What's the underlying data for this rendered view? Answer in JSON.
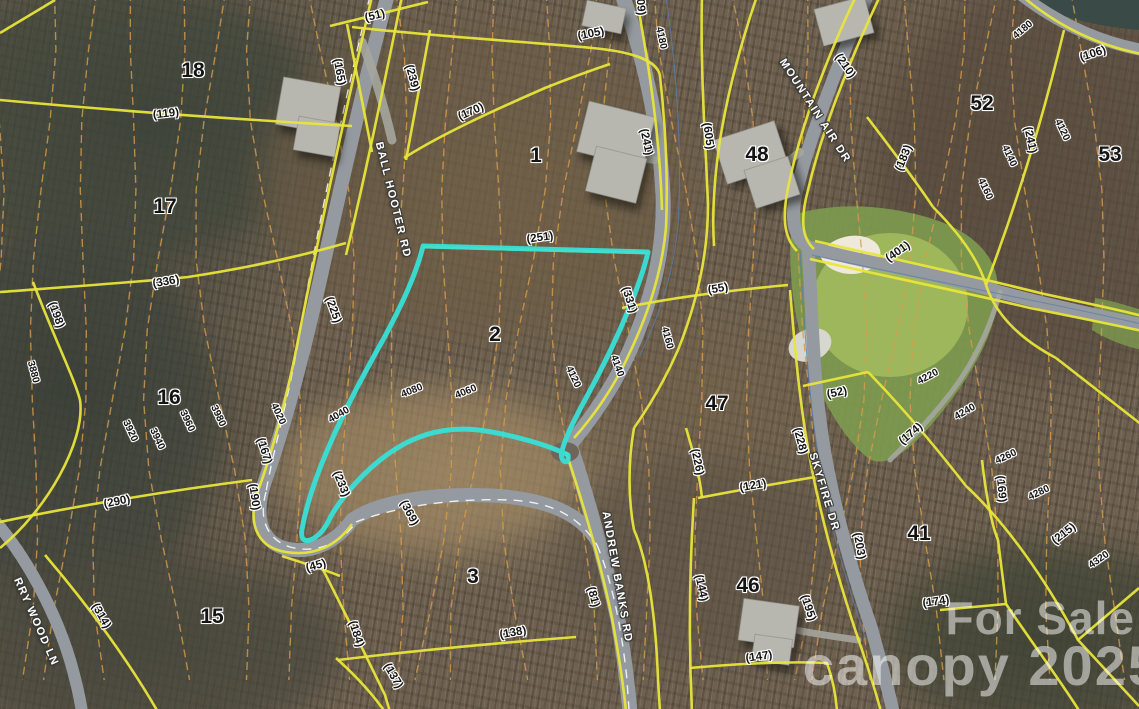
{
  "map": {
    "type": "parcel-aerial-map",
    "colors": {
      "highlight_parcel": "#38dfd6",
      "parcel_boundary": "#e8e53a",
      "contour_line": "#d89c4a",
      "road_fill": "#949aa0",
      "golf_green": "#7d9a4f"
    },
    "watermark": {
      "line1": "For Sale",
      "line2": "canopy 2025"
    }
  },
  "labels": {
    "road_names": [
      {
        "t": "BALL HOOTER RD",
        "x": 393,
        "y": 200,
        "r": 76
      },
      {
        "t": "MOUNTAIN AIR DR",
        "x": 815,
        "y": 111,
        "r": 57
      },
      {
        "t": "ANDREW BANKS RD",
        "x": 617,
        "y": 577,
        "r": 80
      },
      {
        "t": "SKYFIRE DR",
        "x": 824,
        "y": 492,
        "r": 73
      },
      {
        "t": "RRY WOOD LN",
        "x": 36,
        "y": 622,
        "r": 66
      }
    ],
    "parcel_numbers": [
      {
        "t": "18",
        "x": 193,
        "y": 71
      },
      {
        "t": "17",
        "x": 165,
        "y": 207
      },
      {
        "t": "16",
        "x": 169,
        "y": 398
      },
      {
        "t": "15",
        "x": 212,
        "y": 617
      },
      {
        "t": "1",
        "x": 536,
        "y": 156
      },
      {
        "t": "2",
        "x": 495,
        "y": 335
      },
      {
        "t": "3",
        "x": 473,
        "y": 577
      },
      {
        "t": "48",
        "x": 757,
        "y": 155
      },
      {
        "t": "47",
        "x": 717,
        "y": 404
      },
      {
        "t": "46",
        "x": 748,
        "y": 586
      },
      {
        "t": "52",
        "x": 982,
        "y": 104
      },
      {
        "t": "53",
        "x": 1110,
        "y": 155
      },
      {
        "t": "41",
        "x": 919,
        "y": 534
      }
    ],
    "lot_numbers": [
      {
        "t": "(51)",
        "x": 375,
        "y": 16,
        "r": -14
      },
      {
        "t": "(119)",
        "x": 166,
        "y": 114,
        "r": -6
      },
      {
        "t": "(170)",
        "x": 471,
        "y": 112,
        "r": -24
      },
      {
        "t": "(105)",
        "x": 591,
        "y": 34,
        "r": -12
      },
      {
        "t": "(165)",
        "x": 339,
        "y": 72,
        "r": 80
      },
      {
        "t": "(239)",
        "x": 412,
        "y": 78,
        "r": 75
      },
      {
        "t": "(609)",
        "x": 640,
        "y": 2,
        "r": 85
      },
      {
        "t": "(225)",
        "x": 333,
        "y": 310,
        "r": 70
      },
      {
        "t": "(251)",
        "x": 540,
        "y": 238,
        "r": -8
      },
      {
        "t": "(331)",
        "x": 629,
        "y": 300,
        "r": 72
      },
      {
        "t": "(241)",
        "x": 646,
        "y": 142,
        "r": 78
      },
      {
        "t": "(605)",
        "x": 708,
        "y": 136,
        "r": 82
      },
      {
        "t": "(210)",
        "x": 845,
        "y": 66,
        "r": 55
      },
      {
        "t": "(106)",
        "x": 1093,
        "y": 54,
        "r": -18
      },
      {
        "t": "(241)",
        "x": 1030,
        "y": 140,
        "r": 78
      },
      {
        "t": "(183)",
        "x": 904,
        "y": 158,
        "r": -68
      },
      {
        "t": "(401)",
        "x": 898,
        "y": 252,
        "r": -35
      },
      {
        "t": "(55)",
        "x": 718,
        "y": 289,
        "r": -10
      },
      {
        "t": "(226)",
        "x": 697,
        "y": 462,
        "r": 78
      },
      {
        "t": "(228)",
        "x": 800,
        "y": 441,
        "r": 75
      },
      {
        "t": "(121)",
        "x": 753,
        "y": 486,
        "r": -10
      },
      {
        "t": "(52)",
        "x": 837,
        "y": 393,
        "r": -12
      },
      {
        "t": "(174)",
        "x": 911,
        "y": 434,
        "r": -40
      },
      {
        "t": "(174)",
        "x": 936,
        "y": 602,
        "r": -8
      },
      {
        "t": "(203)",
        "x": 859,
        "y": 546,
        "r": 80
      },
      {
        "t": "(169)",
        "x": 1001,
        "y": 489,
        "r": 85
      },
      {
        "t": "(215)",
        "x": 1064,
        "y": 534,
        "r": -38
      },
      {
        "t": "(147)",
        "x": 759,
        "y": 657,
        "r": -8
      },
      {
        "t": "(144)",
        "x": 701,
        "y": 588,
        "r": 78
      },
      {
        "t": "(195)",
        "x": 808,
        "y": 608,
        "r": 72
      },
      {
        "t": "(81)",
        "x": 593,
        "y": 597,
        "r": 75
      },
      {
        "t": "(138)",
        "x": 513,
        "y": 633,
        "r": -10
      },
      {
        "t": "(137)",
        "x": 393,
        "y": 676,
        "r": 60
      },
      {
        "t": "(184)",
        "x": 356,
        "y": 634,
        "r": 72
      },
      {
        "t": "(369)",
        "x": 409,
        "y": 513,
        "r": 62
      },
      {
        "t": "(233)",
        "x": 341,
        "y": 484,
        "r": 68
      },
      {
        "t": "(45)",
        "x": 316,
        "y": 566,
        "r": -16
      },
      {
        "t": "(290)",
        "x": 117,
        "y": 502,
        "r": -12
      },
      {
        "t": "(314)",
        "x": 101,
        "y": 616,
        "r": 60
      },
      {
        "t": "(198)",
        "x": 56,
        "y": 315,
        "r": 70
      },
      {
        "t": "(336)",
        "x": 166,
        "y": 282,
        "r": -10
      },
      {
        "t": "(190)",
        "x": 254,
        "y": 497,
        "r": 82
      },
      {
        "t": "(167)",
        "x": 264,
        "y": 451,
        "r": 72
      }
    ],
    "contour_elevations": [
      {
        "t": "4180",
        "x": 661,
        "y": 38,
        "r": 78
      },
      {
        "t": "4180",
        "x": 1023,
        "y": 30,
        "r": -40
      },
      {
        "t": "4120",
        "x": 1062,
        "y": 130,
        "r": 65
      },
      {
        "t": "4140",
        "x": 1009,
        "y": 156,
        "r": 65
      },
      {
        "t": "4160",
        "x": 985,
        "y": 189,
        "r": 65
      },
      {
        "t": "4160",
        "x": 667,
        "y": 338,
        "r": 75
      },
      {
        "t": "4140",
        "x": 617,
        "y": 366,
        "r": 70
      },
      {
        "t": "4120",
        "x": 573,
        "y": 377,
        "r": 65
      },
      {
        "t": "4060",
        "x": 466,
        "y": 392,
        "r": -22
      },
      {
        "t": "4080",
        "x": 412,
        "y": 391,
        "r": -22
      },
      {
        "t": "4040",
        "x": 339,
        "y": 415,
        "r": -30
      },
      {
        "t": "4020",
        "x": 278,
        "y": 414,
        "r": 65
      },
      {
        "t": "3980",
        "x": 218,
        "y": 416,
        "r": 65
      },
      {
        "t": "3960",
        "x": 187,
        "y": 421,
        "r": 65
      },
      {
        "t": "3940",
        "x": 157,
        "y": 439,
        "r": 65
      },
      {
        "t": "3920",
        "x": 130,
        "y": 431,
        "r": 65
      },
      {
        "t": "3880",
        "x": 33,
        "y": 372,
        "r": 75
      },
      {
        "t": "4220",
        "x": 928,
        "y": 377,
        "r": -28
      },
      {
        "t": "4240",
        "x": 965,
        "y": 412,
        "r": -30
      },
      {
        "t": "4260",
        "x": 1006,
        "y": 457,
        "r": -25
      },
      {
        "t": "4280",
        "x": 1039,
        "y": 493,
        "r": -25
      },
      {
        "t": "4320",
        "x": 1099,
        "y": 560,
        "r": -35
      }
    ]
  }
}
